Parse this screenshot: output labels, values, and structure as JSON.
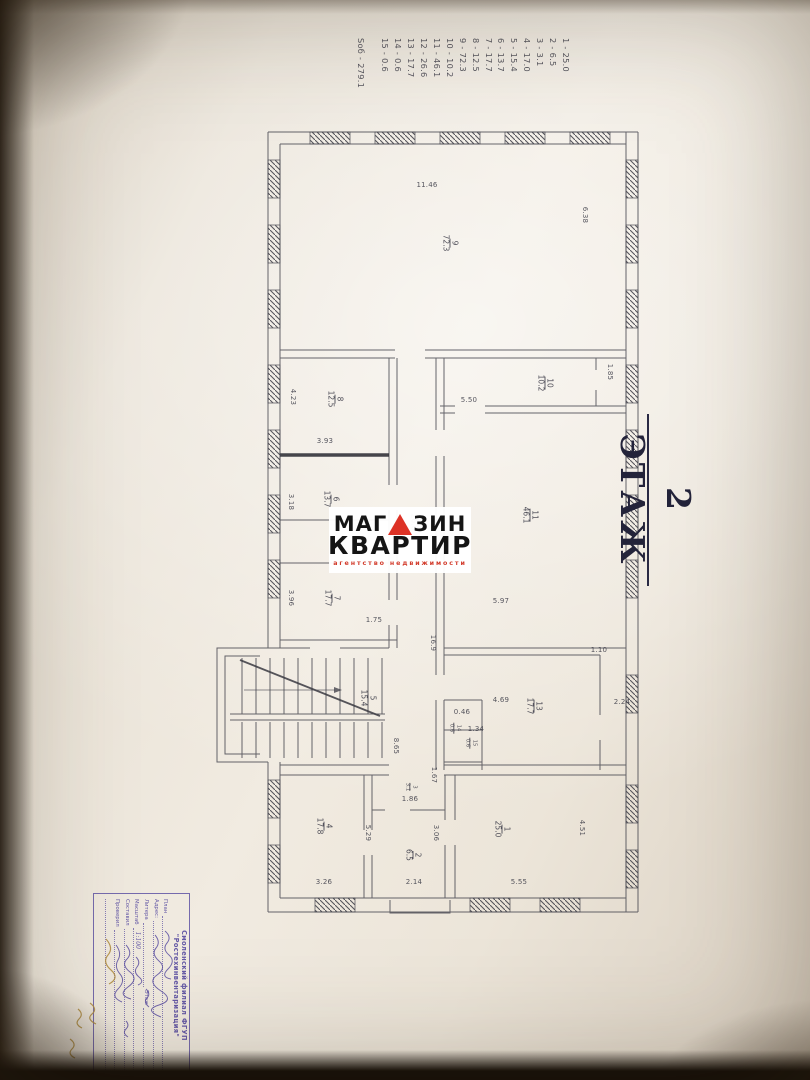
{
  "floor_title": "2 ЭТАЖ",
  "legend": {
    "items": [
      "1 - 25.0",
      "2 - 6.5",
      "3 - 3.1",
      "4 - 17.0",
      "5 - 15.4",
      "6 - 13.7",
      "7 - 17.7",
      "8 - 12.5",
      "9 - 72.3",
      "10 - 10.2",
      "11 - 46.1",
      "12 - 26.6",
      "13 - 17.7",
      "14 - 0.6",
      "15 - 0.6"
    ],
    "total": "Sоб - 279.1"
  },
  "watermark": {
    "line1_left": "МАГ",
    "line1_right": "ЗИН",
    "line2": "КВАРТИР",
    "tagline": "агентство недвижимости",
    "triangle_color": "#dd3226"
  },
  "stamp": {
    "org_line1": "Смоленский филиал ФГУП",
    "org_line2": "\"Ростехинвентаризация\"",
    "rows": [
      {
        "label": "План",
        "value": ""
      },
      {
        "label": "Адрес:",
        "value": ""
      },
      {
        "label": "Литера",
        "value": "",
        "extra": "Этаж"
      },
      {
        "label": "Масштаб",
        "value": "1:100"
      },
      {
        "label": "Составил",
        "value": ""
      },
      {
        "label": "Проверил",
        "value": ""
      },
      {
        "label": "",
        "value": ""
      }
    ]
  },
  "plan": {
    "rooms": [
      {
        "num": "9",
        "area": "72.3",
        "u": 113,
        "v": 190
      },
      {
        "num": "10",
        "area": "10.2",
        "u": 253,
        "v": 95
      },
      {
        "num": "11",
        "area": "46.1",
        "u": 385,
        "v": 110
      },
      {
        "num": "8",
        "area": "12.5",
        "u": 269,
        "v": 305
      },
      {
        "num": "6",
        "area": "13.7",
        "u": 369,
        "v": 309
      },
      {
        "num": "7",
        "area": "17.7",
        "u": 468,
        "v": 308
      },
      {
        "num": "12",
        "area": "26.6",
        "u": 392,
        "v": 222
      },
      {
        "num": "5",
        "area": "15.4",
        "u": 568,
        "v": 272
      },
      {
        "num": "13",
        "area": "17.7",
        "u": 576,
        "v": 106
      },
      {
        "num": "14",
        "area": "0.6",
        "u": 598,
        "v": 186,
        "small": true
      },
      {
        "num": "15",
        "area": "0.6",
        "u": 613,
        "v": 170,
        "small": true
      },
      {
        "num": "1",
        "area": "25.0",
        "u": 699,
        "v": 138
      },
      {
        "num": "2",
        "area": "6.5",
        "u": 725,
        "v": 227
      },
      {
        "num": "3",
        "area": "3.1",
        "u": 657,
        "v": 230,
        "small": true
      },
      {
        "num": "4",
        "area": "17.8",
        "u": 696,
        "v": 316
      }
    ],
    "dims": [
      {
        "t": "11.46",
        "u": 55,
        "v": 213,
        "o": "v"
      },
      {
        "t": "6.38",
        "u": 85,
        "v": 55,
        "o": "h"
      },
      {
        "t": "1.85",
        "u": 242,
        "v": 30,
        "o": "h"
      },
      {
        "t": "5.50",
        "u": 270,
        "v": 171,
        "o": "v"
      },
      {
        "t": "5.97",
        "u": 471,
        "v": 139,
        "o": "v"
      },
      {
        "t": "16.9",
        "u": 513,
        "v": 207,
        "o": "h"
      },
      {
        "t": "3.93",
        "u": 311,
        "v": 315,
        "o": "v"
      },
      {
        "t": "4.23",
        "u": 267,
        "v": 347,
        "o": "h"
      },
      {
        "t": "3.18",
        "u": 372,
        "v": 349,
        "o": "h"
      },
      {
        "t": "3.96",
        "u": 468,
        "v": 349,
        "o": "h"
      },
      {
        "t": "1.75",
        "u": 490,
        "v": 266,
        "o": "v"
      },
      {
        "t": "4.69",
        "u": 570,
        "v": 139,
        "o": "v"
      },
      {
        "t": "2.24",
        "u": 572,
        "v": 18,
        "o": "v"
      },
      {
        "t": "1.10",
        "u": 520,
        "v": 41,
        "o": "v"
      },
      {
        "t": "0.46",
        "u": 582,
        "v": 178,
        "o": "v"
      },
      {
        "t": "1.34",
        "u": 599,
        "v": 164,
        "o": "v"
      },
      {
        "t": "8.65",
        "u": 616,
        "v": 244,
        "o": "h"
      },
      {
        "t": "1.67",
        "u": 645,
        "v": 206,
        "o": "h"
      },
      {
        "t": "1.86",
        "u": 669,
        "v": 230,
        "o": "v"
      },
      {
        "t": "3.06",
        "u": 703,
        "v": 204,
        "o": "h"
      },
      {
        "t": "2.14",
        "u": 752,
        "v": 226,
        "o": "v"
      },
      {
        "t": "5.29",
        "u": 703,
        "v": 272,
        "o": "h"
      },
      {
        "t": "3.26",
        "u": 752,
        "v": 316,
        "o": "v"
      },
      {
        "t": "4.51",
        "u": 698,
        "v": 58,
        "o": "h"
      },
      {
        "t": "5.55",
        "u": 752,
        "v": 121,
        "o": "v"
      }
    ]
  },
  "colors": {
    "plan_line": "#45454e",
    "stamp_ink": "#564aa0",
    "stamp_amber": "#b08c3e",
    "logo_red": "#dd3226",
    "title_ink": "#23233a"
  }
}
